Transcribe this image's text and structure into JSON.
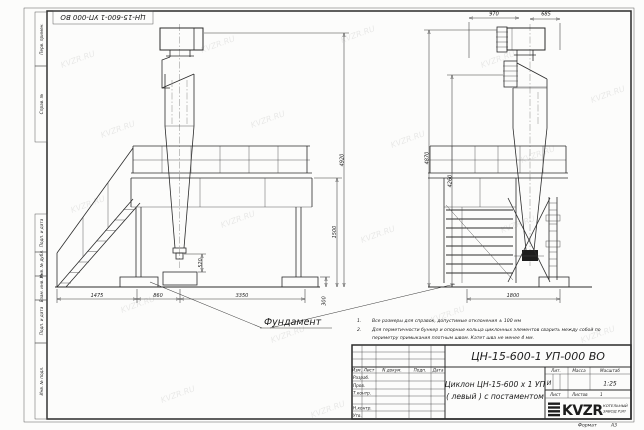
{
  "watermark": "KVZR.RU",
  "stamp_top": "ЦН-15-600-1 УП-000  ВО",
  "margin": {
    "m1": "Перв. примен.",
    "m2": "Справ. №",
    "m3": "Подп. и дата",
    "m4": "Инв. № дубл.",
    "m5": "Взам. инв. №",
    "m6": "Подп. и дата",
    "m7": "Инв. № подл."
  },
  "dims": {
    "d1475": "1475",
    "d860": "860",
    "d3350": "3350",
    "d520": "520",
    "d4920": "4920",
    "d4870": "4870",
    "d4260": "4260",
    "d1500": "1500",
    "d300": "300",
    "d970": "970",
    "d685": "685",
    "d1800": "1800"
  },
  "labels": {
    "foundation": "Фундамент"
  },
  "notes": {
    "n1_num": "1.",
    "n1": "Все размеры для справок, допустимые отклонения  ± 100 мм",
    "n2_num": "2.",
    "n2": "Для герметичности бункер и опорные кольца циклонных элементов сварить между собой по",
    "n2b": "периметру примыкания плотным швом. Катет шва не менее  4 мм."
  },
  "title_block": {
    "doc_number": "ЦН-15-600-1 УП-000  ВО",
    "name_line1": "Циклон ЦН-15-600 х 1 УП",
    "name_line2": "( левый )  с постаментом",
    "lit": "И",
    "scale": "1:25",
    "headers": {
      "izm": "Изм.",
      "list": "Лист",
      "ndoc": "N докум.",
      "podp": "Подп.",
      "data": "Дата",
      "lit": "Лит.",
      "massa": "Масса",
      "masshtab": "Масштаб",
      "list2": "Лист",
      "listov": "Листов",
      "listov_val": "1"
    },
    "rows": {
      "razrab": "Разраб.",
      "prov": "Пров.",
      "tkontr": "Т.контр.",
      "nkontr": "Н.контр.",
      "utv": "Утв."
    },
    "logo_text": "KVZR",
    "logo_sub1": "КОТЕЛЬНЫЙ",
    "logo_sub2": "ЗАВОД РЭП",
    "format_label": "Формат",
    "format_val": "А3"
  }
}
